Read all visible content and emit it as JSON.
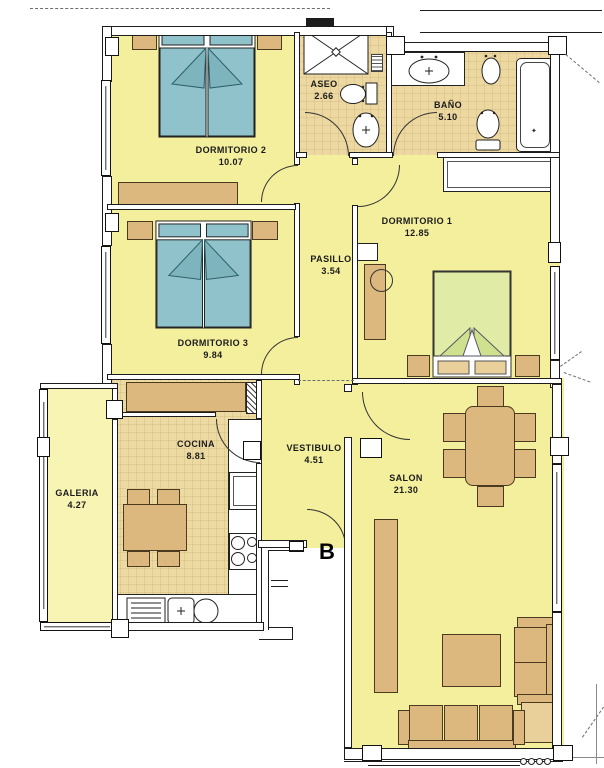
{
  "unit": {
    "label": "B"
  },
  "rooms": [
    {
      "name": "DORMITORIO 2",
      "area": "10.07"
    },
    {
      "name": "ASEO",
      "area": "2.66"
    },
    {
      "name": "BAÑO",
      "area": "5.10"
    },
    {
      "name": "DORMITORIO 1",
      "area": "12.85"
    },
    {
      "name": "PASILLO",
      "area": "3.54"
    },
    {
      "name": "DORMITORIO 3",
      "area": "9.84"
    },
    {
      "name": "COCINA",
      "area": "8.81"
    },
    {
      "name": "VESTIBULO",
      "area": "4.51"
    },
    {
      "name": "GALERIA",
      "area": "4.27"
    },
    {
      "name": "SALON",
      "area": "21.30"
    }
  ],
  "colors": {
    "room_yellow": "#f3ef9d",
    "galeria_yellow": "#f7f4b4",
    "bath_tan": "#ecd8a0",
    "kitchen_tan": "#eddaa3",
    "furniture_tan": "#dcb87e",
    "furniture_light": "#e9d09a",
    "bed_blue": "#8fc2ca",
    "bed_blue_dark": "#7db4bd",
    "bed_green": "#e0eba6",
    "bed_green_dark": "#cfe18f",
    "wall_line": "#1c1c1c"
  }
}
